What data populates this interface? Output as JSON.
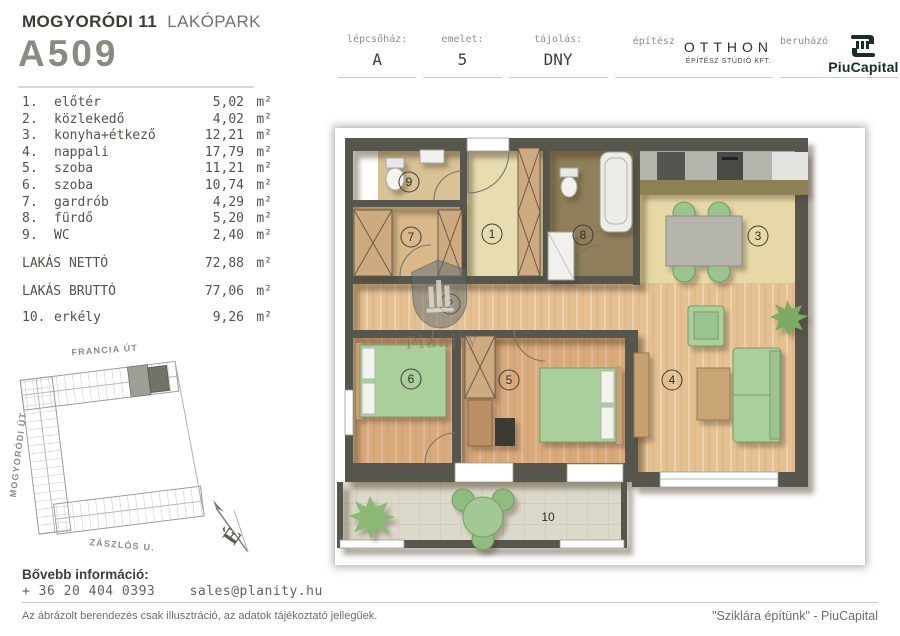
{
  "header": {
    "project_bold": "MOGYORÓDI 11",
    "project_light": "LAKÓPARK",
    "unit_id": "A509",
    "info": {
      "staircase_label": "lépcsőház:",
      "staircase_value": "A",
      "floor_label": "emelet:",
      "floor_value": "5",
      "orientation_label": "tájolás:",
      "orientation_value": "DNY",
      "architect_label": "építész",
      "architect_name": "OTTHON",
      "architect_sub": "ÉPÍTÉSZ STÚDIÓ KFT.",
      "developer_label": "beruházó",
      "developer_name": "PiuCapital"
    }
  },
  "room_list": {
    "unit_suffix": "m²",
    "rooms": [
      {
        "num": "1.",
        "name": "előtér",
        "area": "5,02"
      },
      {
        "num": "2.",
        "name": "közlekedő",
        "area": "4,02"
      },
      {
        "num": "3.",
        "name": "konyha+étkező",
        "area": "12,21"
      },
      {
        "num": "4.",
        "name": "nappali",
        "area": "17,79"
      },
      {
        "num": "5.",
        "name": "szoba",
        "area": "11,21"
      },
      {
        "num": "6.",
        "name": "szoba",
        "area": "10,74"
      },
      {
        "num": "7.",
        "name": "gardrób",
        "area": "4,29"
      },
      {
        "num": "8.",
        "name": "fürdő",
        "area": "5,20"
      },
      {
        "num": "9.",
        "name": "WC",
        "area": "2,40"
      }
    ],
    "net_label": "LAKÁS NETTÓ",
    "net_area": "72,88",
    "gross_label": "LAKÁS BRUTTÓ",
    "gross_area": "77,06",
    "balcony_num": "10.",
    "balcony_name": "erkély",
    "balcony_area": "9,26"
  },
  "site_map": {
    "street_top": "FRANCIA ÚT",
    "street_left": "MOGYORÓDI ÚT",
    "street_bottom": "ZÁSZLÓS U.",
    "compass_letter": "É"
  },
  "plan": {
    "room_numbers": [
      "1",
      "2",
      "3",
      "4",
      "5",
      "6",
      "7",
      "8",
      "9",
      "10"
    ],
    "watermark": "Planity"
  },
  "footer": {
    "info_label": "Bővebb információ:",
    "phone": "+ 36 20 404 0393",
    "email": "sales@planity.hu",
    "disclaimer": "Az ábrázolt berendezés csak illusztráció, az adatok tájékoztató jellegűek.",
    "slogan": "\"Sziklára építünk\" - PiuCapital"
  },
  "colors": {
    "text": "#4b4b43",
    "wall": "#57564d",
    "furniture_green": "#a9cf9b",
    "developer_dark": "#17301f"
  }
}
